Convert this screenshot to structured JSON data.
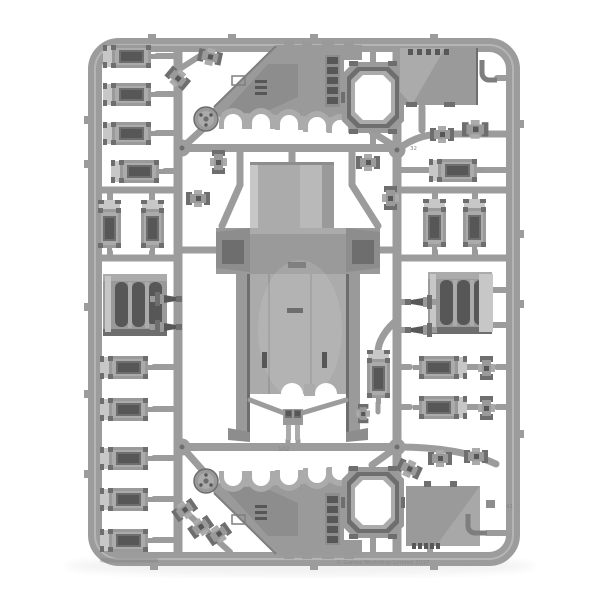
{
  "image": {
    "kind": "photograph",
    "subject": "Grey plastic model-kit sprue (vehicle frame) on a white background: central tank hull, two arched track side-sections, hatch rings, roof panels, door and hatch panels, vent blocks, exhausts and small fittings",
    "background": "#ffffff"
  },
  "palette": {
    "bg": "#ffffff",
    "runner": "#9c9c9c",
    "base": "#9a9a9a",
    "base2": "#8d8d8d",
    "mid": "#ababab",
    "light": "#c7c7c7",
    "lighter": "#dddddd",
    "dark": "#6e6e6e",
    "deep": "#575757",
    "edge": "#7e7e7e",
    "marking": "#848484"
  },
  "markings": {
    "copyright": "© Games Workshop Limited 2017",
    "part_numbers": [
      "32",
      "41",
      "102"
    ]
  },
  "parts_inventory": [
    {
      "name": "main hull body",
      "count": 1
    },
    {
      "name": "track side-section with wheel arches and dome",
      "count": 2
    },
    {
      "name": "door / hatch panel",
      "count": 17
    },
    {
      "name": "track vent block",
      "count": 2
    },
    {
      "name": "hatch ring frame",
      "count": 2
    },
    {
      "name": "flat roof panel",
      "count": 2
    },
    {
      "name": "exhaust / smoke launcher",
      "count": 4
    },
    {
      "name": "small fitting clip",
      "count": 17
    },
    {
      "name": "towing bracket",
      "count": 1
    }
  ]
}
